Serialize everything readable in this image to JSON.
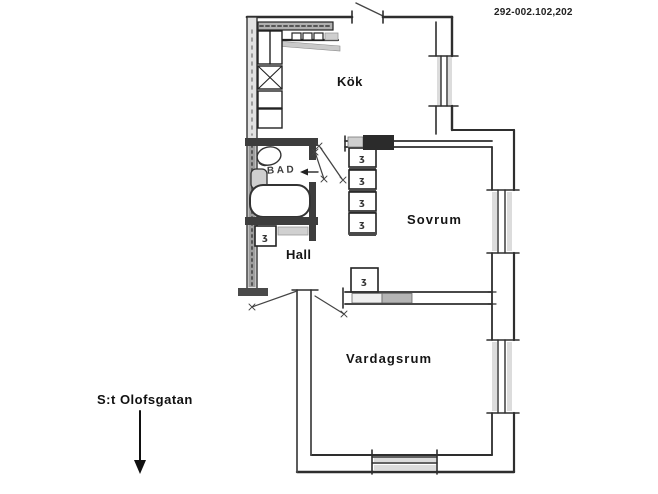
{
  "plan": {
    "reference_number": "292-002.102,202",
    "street_label": "S:t Olofsgatan",
    "street_arrow_direction": "down",
    "rooms": {
      "kitchen": {
        "label": "Kök"
      },
      "bedroom": {
        "label": "Sovrum"
      },
      "hall": {
        "label": "Hall"
      },
      "bathroom": {
        "label": "BAD"
      },
      "living_room": {
        "label": "Vardagsrum"
      }
    },
    "closet_glyph": "ʒ",
    "colors": {
      "line": "#2e2e2e",
      "wall_dark": "#3d3d3d",
      "hatch_light": "#dcdcdc",
      "hatch_mid": "#b3b3b3",
      "background": "#ffffff"
    }
  }
}
